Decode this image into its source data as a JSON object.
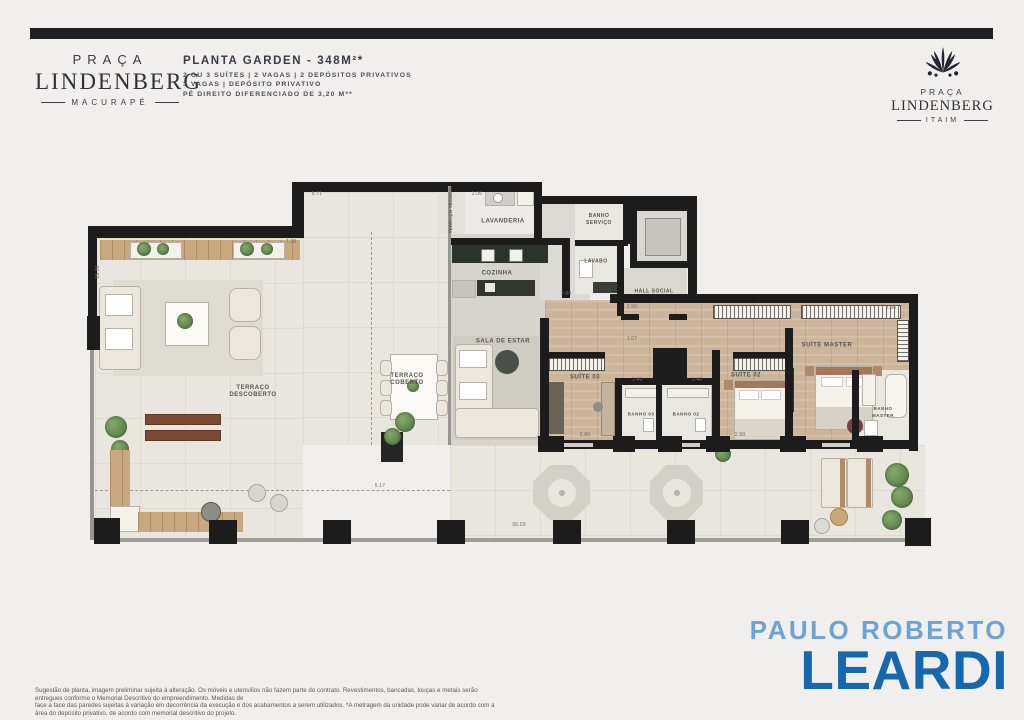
{
  "header": {
    "logo_left": {
      "top": "PRAÇA",
      "main": "LINDENBERG",
      "sub": "MACURAPÉ"
    },
    "title": "PLANTA GARDEN - 348M²*",
    "specs": [
      "2 OU 3 SUÍTES | 2 VAGAS | 2 DEPÓSITOS PRIVATIVOS",
      "3 VAGAS | DEPÓSITO PRIVATIVO",
      "PÉ DIREITO DIFERENCIADO DE 3,20 M**"
    ],
    "logo_right": {
      "top": "PRAÇA",
      "main": "LINDENBERG",
      "sub": "ITAIM"
    }
  },
  "plan": {
    "rooms": {
      "terraco_descoberto": "TERRAÇO DESCOBERTO",
      "terraco_coberto": "TERRAÇO COBERTO",
      "terraco_tecnico": "TERRAÇO TÉCNICO",
      "sala_de_estar": "SALA DE ESTAR",
      "cozinha": "COZINHA",
      "lavanderia": "LAVANDERIA",
      "banho_servico": "BANHO SERVIÇO",
      "lavabo": "LAVABO",
      "hall_social": "HALL SOCIAL",
      "suite_master": "SUÍTE MASTER",
      "suite_02": "SUÍTE 02",
      "suite_03": "SUÍTE 03",
      "banho_02": "BANHO 02",
      "banho_03": "BANHO 03",
      "banho_master": "BANHO MASTER"
    },
    "dims": {
      "d571": "5.71",
      "d728": "7.28",
      "d1536": "15.36",
      "d206": "2.06",
      "d294": "2.94",
      "d190": "1.90",
      "d107": "1.07",
      "d149": "1.49",
      "d140": "1.40",
      "d280": "2.80",
      "d290": "2.90",
      "d336": "3.36",
      "d517": "5.17",
      "d3603": "36.03"
    }
  },
  "footer": {
    "disclaimer1": "Sugestão de planta, imagem preliminar sujeita à alteração. Os móveis e utensílios não fazem parte do contrato. Revestimentos, bancadas, louças e metais serão entregues conforme o Memorial Descritivo do empreendimento. Medidas de",
    "disclaimer2": "face a face das paredes sujeitas à variação em decorrência da execução e dos acabamentos a serem utilizados. *A metragem da unidade pode variar de acordo com a área do depósito privativo, de acordo com memorial descritivo do projeto.",
    "brand_top": "PAULO ROBERTO",
    "brand_name": "LEARDI"
  },
  "colors": {
    "brand_blue": "#1568ae",
    "brand_blue_light": "#6ba3d6",
    "top_bar": "#202024",
    "wall": "#1c1c1c",
    "terrace_floor": "#e9e6df",
    "indoor_floor": "#d7d4cd",
    "wood_floor": "#cdb59b",
    "deck_wood": "#c9a87f",
    "kitchen_counter": "#2a332c"
  }
}
